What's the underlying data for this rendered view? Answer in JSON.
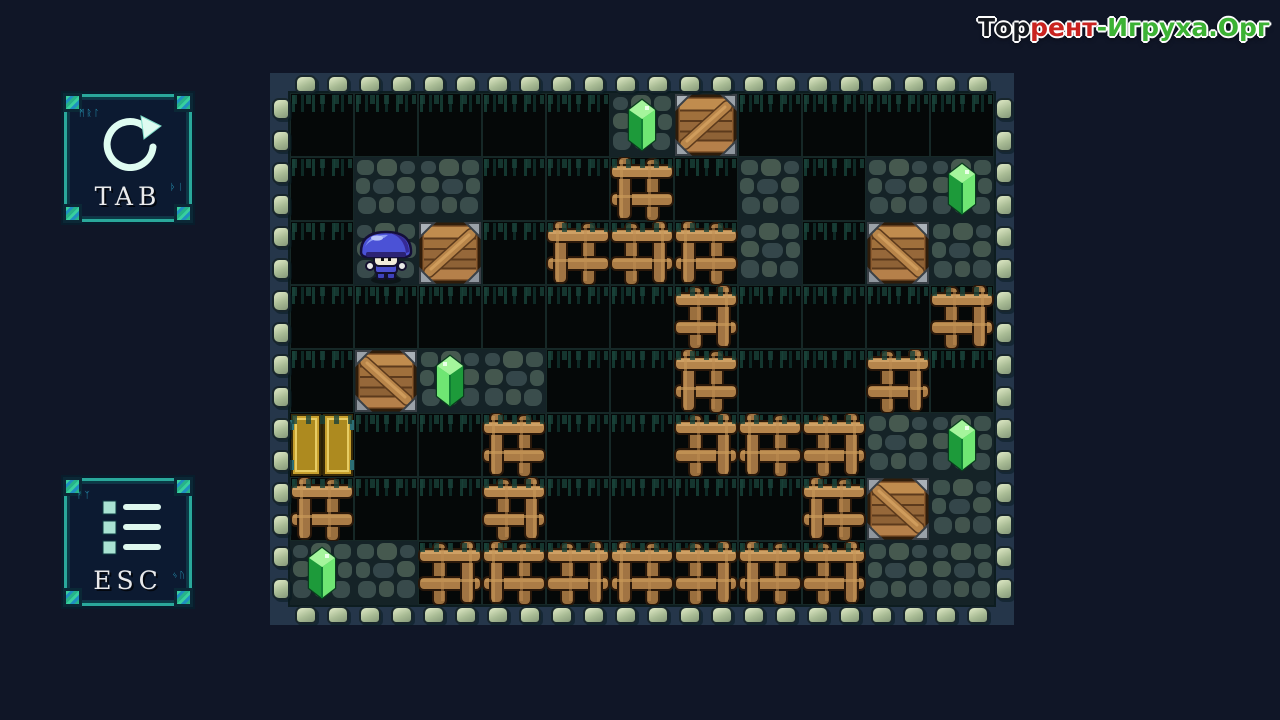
{
  "page_type": "sokoban-puzzle-game-level",
  "watermark": {
    "part1": "Тор",
    "part2": "рент",
    "part3": "-Игруха.Орг",
    "color_part1": "#15181f",
    "color_part2": "#c9231f",
    "color_part3": "#3cb234"
  },
  "hotkeys": {
    "restart": {
      "label": "TAB",
      "icon": "restart-circular-arrow-icon"
    },
    "menu": {
      "label": "ESC",
      "icon": "menu-list-icon"
    }
  },
  "board": {
    "cols": 11,
    "rows": 8,
    "tile_size": 64,
    "legend": {
      "k": "void-floor",
      "s": "stone-floor",
      "w": "wood-lattice-wall",
      "c": "crate-on-stone",
      "g": "gem-on-stone",
      "p": "player-on-stone",
      "d": "gold-exit-door"
    },
    "grid": [
      "kkkkkgckkkk",
      "ksskkwksksg",
      "kpckwwwskcs",
      "kkkkkkwkkkw",
      "kcgskkwkkwk",
      "dkkwkkwwwsg",
      "wkkwkkkkwcs",
      "gswwwwwwwss"
    ],
    "entities": {
      "player": {
        "col": 1,
        "row": 2
      },
      "door": {
        "col": 0,
        "row": 5
      },
      "crates": [
        [
          6,
          0
        ],
        [
          2,
          2
        ],
        [
          9,
          2
        ],
        [
          1,
          4
        ],
        [
          9,
          6
        ]
      ],
      "gems": [
        [
          5,
          0
        ],
        [
          10,
          1
        ],
        [
          2,
          4
        ],
        [
          10,
          5
        ],
        [
          0,
          7
        ]
      ]
    },
    "counts": {
      "crates": 5,
      "gems": 5
    }
  },
  "colors": {
    "page_bg": "#101627",
    "board_band": "#25364a",
    "bump": "#b7c9a4",
    "panel_bg": "#0c1a31",
    "panel_border_teal": "#2aa89b",
    "stone": "#3d514c",
    "wood": "#a87a46",
    "crate": "#a06a38",
    "gem_green": "#35c948",
    "door_gold": "#c7a02e",
    "player_cap_blue": "#4b52d6"
  }
}
